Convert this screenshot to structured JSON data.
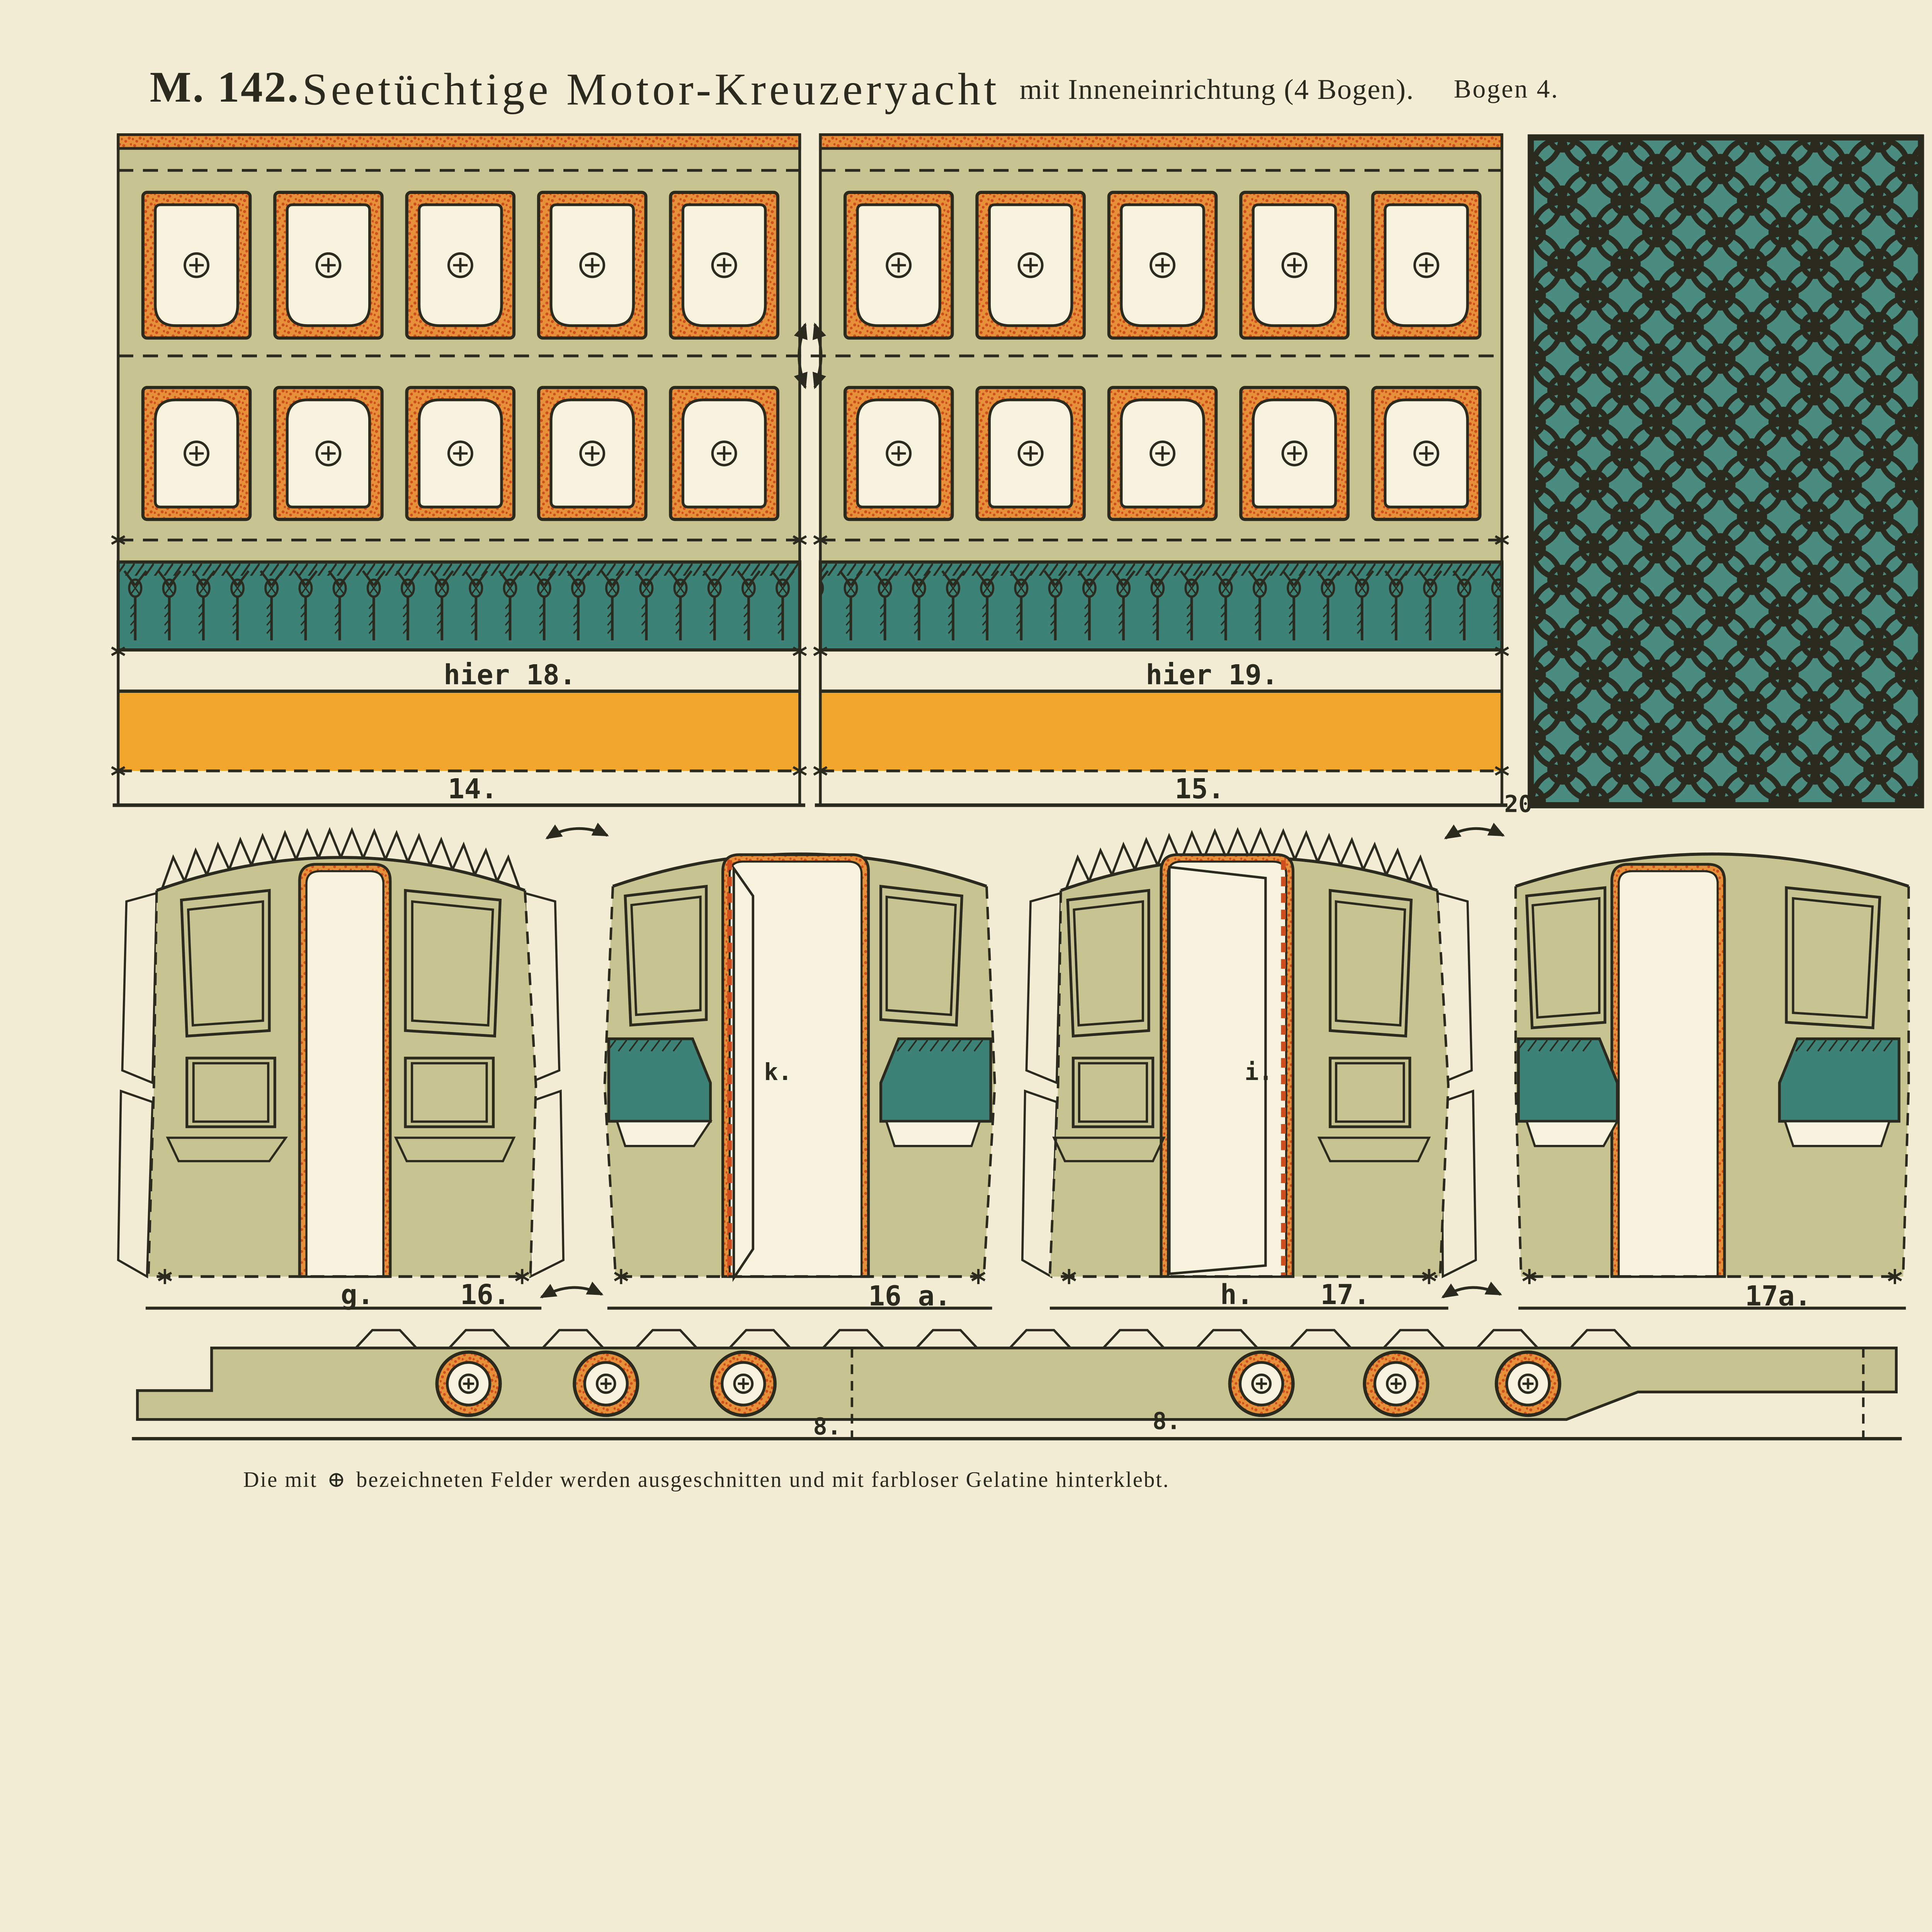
{
  "title": {
    "series": "M. 142.",
    "name": "Seetüchtige Motor-Kreuzeryacht",
    "subtitle": "mit Inneneinrichtung (4 Bogen).",
    "sheet": "Bogen 4."
  },
  "side_panels": {
    "left": {
      "glue_hint": "hier 18.",
      "part_number": "14."
    },
    "right": {
      "glue_hint": "hier 19.",
      "part_number": "15."
    }
  },
  "lattice_panel": {
    "part_number": "20"
  },
  "end_walls": {
    "wall_16": {
      "letter": "g.",
      "part_number": "16."
    },
    "wall_16a": {
      "part_number": "16 a.",
      "door_letter": "k."
    },
    "wall_17": {
      "letter": "h.",
      "part_number": "17.",
      "door_letter": "i."
    },
    "wall_17a": {
      "part_number": "17a."
    }
  },
  "hull_strip": {
    "part_number_left": "8.",
    "part_number_right": "8."
  },
  "footnote": {
    "prefix": "Die mit",
    "symbol": "⊕",
    "suffix": "bezeichneten Felder werden ausgeschnitten und mit farbloser Gelatine hinterklebt."
  },
  "colors": {
    "page": "#f3edd6",
    "olive": "#c8c491",
    "cream": "#f8f3de",
    "orange": "#e6913a",
    "orange_dot": "#cf4e1d",
    "yellow": "#f2a62c",
    "teal": "#3d8276",
    "lattice": "#4a8c80",
    "ink": "#2b2a1e"
  }
}
